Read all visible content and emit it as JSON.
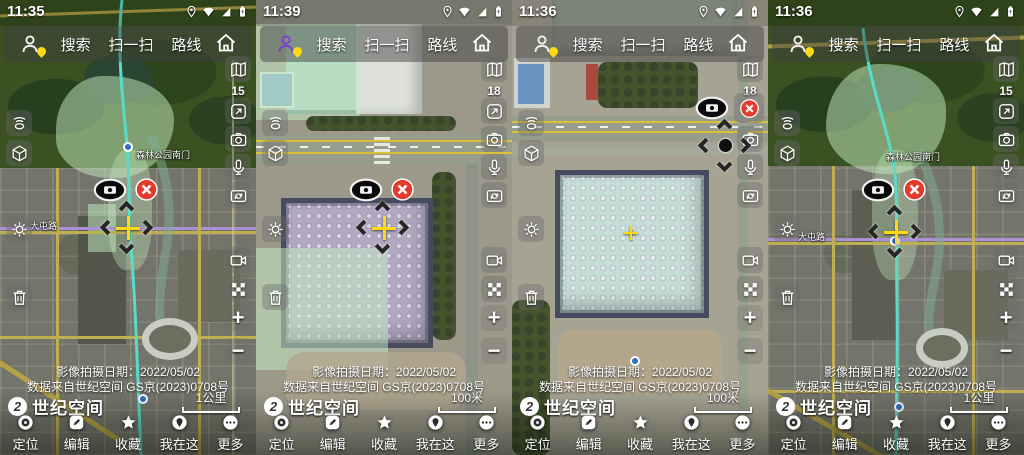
{
  "app": {
    "name": "世纪空间",
    "search_label": "搜索",
    "scan_label": "扫一扫",
    "route_label": "路线"
  },
  "panels": [
    {
      "time": "11:35",
      "zoom_level": "15",
      "scale_label": "1公里",
      "map_labels": {
        "metro_road": "大屯路",
        "station": "森林公园南门"
      }
    },
    {
      "time": "11:39",
      "zoom_level": "18",
      "scale_label": "100米"
    },
    {
      "time": "11:36",
      "zoom_level": "18",
      "scale_label": "100米"
    },
    {
      "time": "11:36",
      "zoom_level": "15",
      "scale_label": "1公里",
      "map_labels": {
        "metro_road": "大屯路",
        "station": "森林公园南门"
      }
    }
  ],
  "attribution": {
    "capture_date_line": "影像拍摄日期：2022/05/02",
    "license_line": "数据来自世纪空间 GS京(2023)0708号"
  },
  "brand": {
    "logo_mark": "2",
    "name": "世纪空间"
  },
  "nav": [
    "定位",
    "编辑",
    "收藏",
    "我在这",
    "更多"
  ],
  "controls": {
    "zoom_in_label": "+",
    "zoom_out_label": "−"
  },
  "icons": {
    "status": [
      "location-pin-icon",
      "wifi-icon",
      "signal-icon",
      "battery-icon"
    ],
    "search": [
      "profile-icon",
      "home-icon"
    ],
    "left_rail": [
      "hotspot-icon",
      "cube-3d-icon",
      "settings-gear-icon",
      "trash-icon"
    ],
    "right_rail": [
      "map-layers-icon",
      "fullscreen-icon",
      "camera-icon",
      "mic-icon",
      "camera-switch-icon",
      "video-camera-icon",
      "checker-grid-icon"
    ],
    "map_markers": [
      "camera-oval-icon",
      "close-x-icon",
      "pan-chevrons",
      "yellow-crosshair",
      "metro-station-dot"
    ],
    "nav": [
      "locate-target-icon",
      "pencil-icon",
      "star-icon",
      "location-pin-icon",
      "more-dots-icon"
    ]
  },
  "colors": {
    "accent_yellow": "#ffd911",
    "close_red": "#e23b2e",
    "route_teal": "#58dcc8",
    "metro_purple": "#ad8fd6",
    "selection_green": "rgba(198,240,198,0.5)",
    "profile_purple": "#7b3fd6"
  }
}
